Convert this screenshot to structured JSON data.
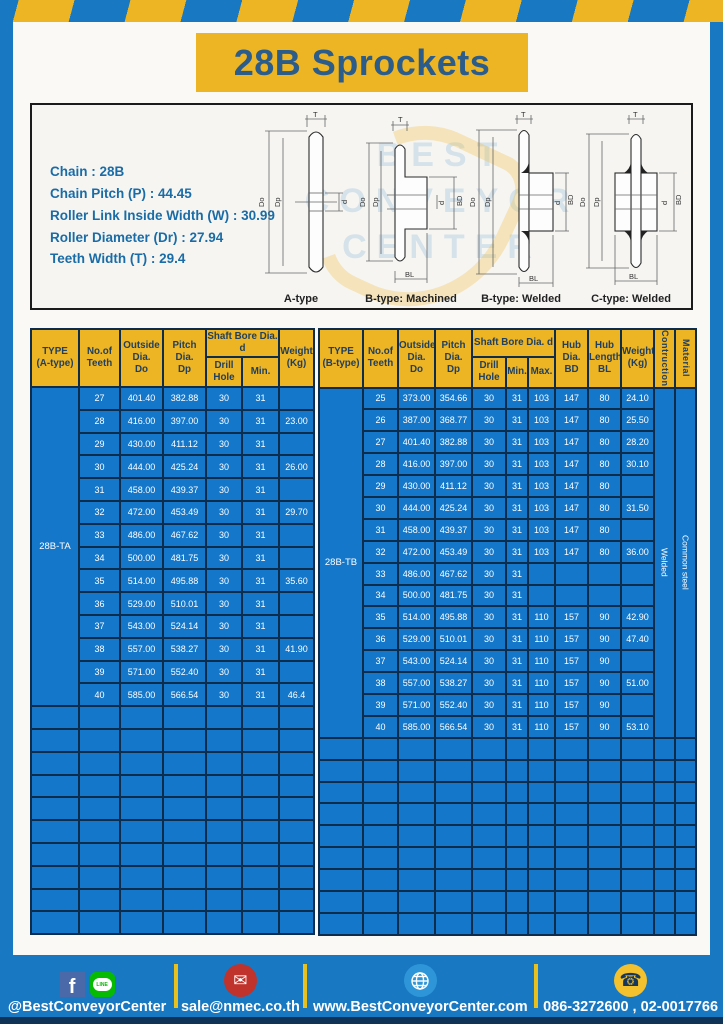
{
  "page": {
    "title": "28B Sprockets"
  },
  "colors": {
    "frame_blue": "#1878c2",
    "accent_yellow": "#edb424",
    "cell_blue": "#1477c9",
    "border_navy": "#0e2c4c",
    "title_text": "#2b5c8a",
    "spec_text": "#1a6ca6"
  },
  "specs": {
    "lines": "Chain : 28B\nChain Pitch (P) : 44.45\nRoller Link Inside Width (W) : 30.99\nRoller Diameter (Dr) : 27.94\nTeeth Width (T) : 29.4"
  },
  "watermark": "BEST\nCONVEYOR\nCENTER",
  "drawings": {
    "captions": [
      "A-type",
      "B-type: Machined",
      "B-type: Welded",
      "C-type: Welded"
    ],
    "dims": {
      "t": "T",
      "outside": "Do",
      "pitch": "Dp",
      "bore": "d",
      "hub_len": "BL",
      "hub_dia": "BD"
    }
  },
  "table_a": {
    "headers": {
      "type": "TYPE\n(A-type)",
      "teeth": "No.of\nTeeth",
      "outside": "Outside\nDia.\nDo",
      "pitch": "Pitch Dia.\nDp",
      "shaft_bore": "Shaft Bore Dia. d",
      "drill_hole": "Drill Hole",
      "min": "Min.",
      "weight": "Weight\n(Kg)"
    },
    "type_label": "28B-TA",
    "rows": [
      [
        "27",
        "401.40",
        "382.88",
        "30",
        "31",
        ""
      ],
      [
        "28",
        "416.00",
        "397.00",
        "30",
        "31",
        "23.00"
      ],
      [
        "29",
        "430.00",
        "411.12",
        "30",
        "31",
        ""
      ],
      [
        "30",
        "444.00",
        "425.24",
        "30",
        "31",
        "26.00"
      ],
      [
        "31",
        "458.00",
        "439.37",
        "30",
        "31",
        ""
      ],
      [
        "32",
        "472.00",
        "453.49",
        "30",
        "31",
        "29.70"
      ],
      [
        "33",
        "486.00",
        "467.62",
        "30",
        "31",
        ""
      ],
      [
        "34",
        "500.00",
        "481.75",
        "30",
        "31",
        ""
      ],
      [
        "35",
        "514.00",
        "495.88",
        "30",
        "31",
        "35.60"
      ],
      [
        "36",
        "529.00",
        "510.01",
        "30",
        "31",
        ""
      ],
      [
        "37",
        "543.00",
        "524.14",
        "30",
        "31",
        ""
      ],
      [
        "38",
        "557.00",
        "538.27",
        "30",
        "31",
        "41.90"
      ],
      [
        "39",
        "571.00",
        "552.40",
        "30",
        "31",
        ""
      ],
      [
        "40",
        "585.00",
        "566.54",
        "30",
        "31",
        "46.4"
      ]
    ],
    "empty_rows": 10,
    "empty_cols": 7
  },
  "table_b": {
    "headers": {
      "type": "TYPE\n(B-type)",
      "teeth": "No.of\nTeeth",
      "outside": "Outside\nDia.\nDo",
      "pitch": "Pitch Dia.\nDp",
      "shaft_bore": "Shaft Bore Dia. d",
      "drill_hole": "Drill Hole",
      "min": "Min.",
      "max": "Max.",
      "hub_dia": "Hub Dia.\nBD",
      "hub_length": "Hub\nLength\nBL",
      "weight": "Weight\n(Kg)",
      "construction": "Contruction",
      "material": "Material"
    },
    "type_label": "28B-TB",
    "construction_value": "Welded",
    "material_value": "Common steel",
    "rows": [
      [
        "25",
        "373.00",
        "354.66",
        "30",
        "31",
        "103",
        "147",
        "80",
        "24.10"
      ],
      [
        "26",
        "387.00",
        "368.77",
        "30",
        "31",
        "103",
        "147",
        "80",
        "25.50"
      ],
      [
        "27",
        "401.40",
        "382.88",
        "30",
        "31",
        "103",
        "147",
        "80",
        "28.20"
      ],
      [
        "28",
        "416.00",
        "397.00",
        "30",
        "31",
        "103",
        "147",
        "80",
        "30.10"
      ],
      [
        "29",
        "430.00",
        "411.12",
        "30",
        "31",
        "103",
        "147",
        "80",
        ""
      ],
      [
        "30",
        "444.00",
        "425.24",
        "30",
        "31",
        "103",
        "147",
        "80",
        "31.50"
      ],
      [
        "31",
        "458.00",
        "439.37",
        "30",
        "31",
        "103",
        "147",
        "80",
        ""
      ],
      [
        "32",
        "472.00",
        "453.49",
        "30",
        "31",
        "103",
        "147",
        "80",
        "36.00"
      ],
      [
        "33",
        "486.00",
        "467.62",
        "30",
        "31",
        "",
        "",
        "",
        ""
      ],
      [
        "34",
        "500.00",
        "481.75",
        "30",
        "31",
        "",
        "",
        "",
        ""
      ],
      [
        "35",
        "514.00",
        "495.88",
        "30",
        "31",
        "110",
        "157",
        "90",
        "42.90"
      ],
      [
        "36",
        "529.00",
        "510.01",
        "30",
        "31",
        "110",
        "157",
        "90",
        "47.40"
      ],
      [
        "37",
        "543.00",
        "524.14",
        "30",
        "31",
        "110",
        "157",
        "90",
        ""
      ],
      [
        "38",
        "557.00",
        "538.27",
        "30",
        "31",
        "110",
        "157",
        "90",
        "51.00"
      ],
      [
        "39",
        "571.00",
        "552.40",
        "30",
        "31",
        "110",
        "157",
        "90",
        ""
      ],
      [
        "40",
        "585.00",
        "566.54",
        "30",
        "31",
        "110",
        "157",
        "90",
        "53.10"
      ]
    ],
    "empty_rows": 9,
    "empty_cols": 12
  },
  "footer": {
    "social_handle": "@BestConveyorCenter",
    "email": "sale@nmec.co.th",
    "website": "www.BestConveyorCenter.com",
    "phones": "086-3272600 , 02-0017766",
    "line_label": "LINE",
    "fb_letter": "f"
  }
}
